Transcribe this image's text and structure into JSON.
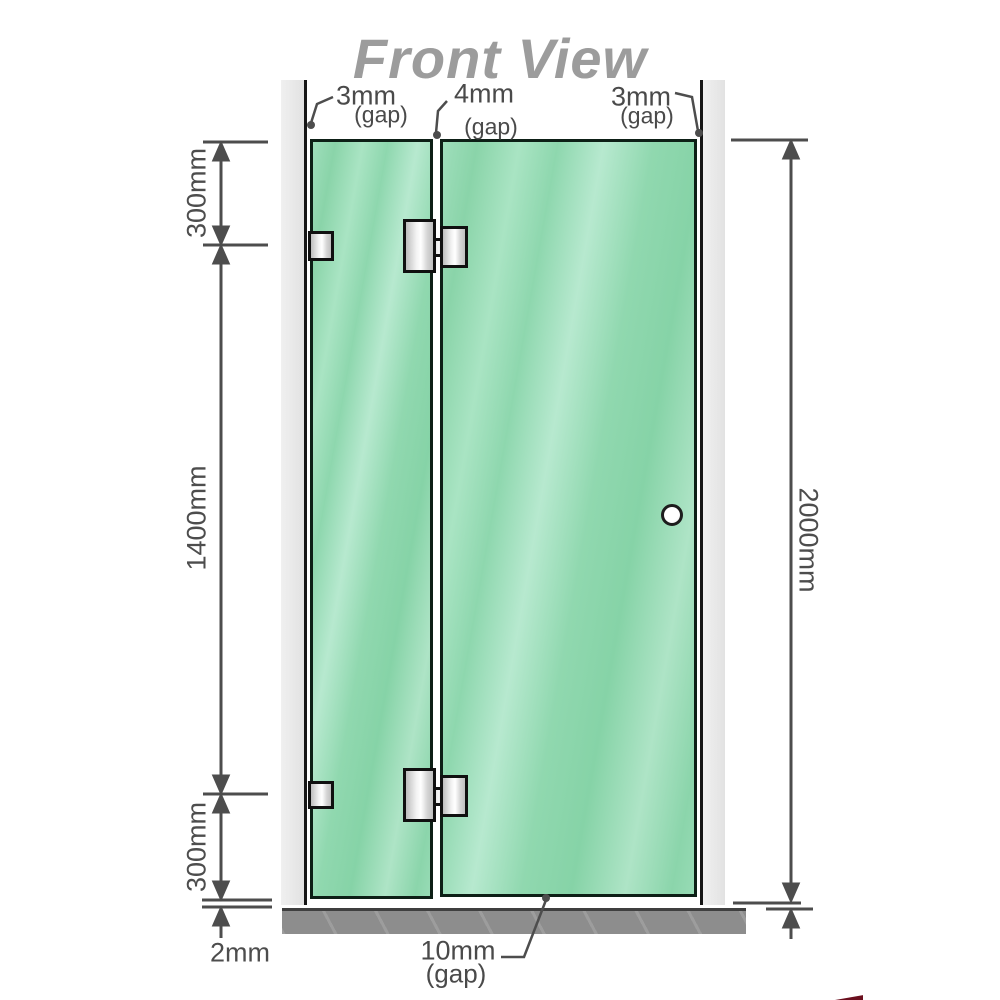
{
  "title": "Front View",
  "gaps": {
    "top_left": {
      "value": "3mm",
      "suffix": "(gap)"
    },
    "top_mid": {
      "value": "4mm",
      "suffix": "(gap)"
    },
    "top_right": {
      "value": "3mm",
      "suffix": "(gap)"
    },
    "bottom": {
      "value": "10mm",
      "suffix": "(gap)"
    }
  },
  "dimensions": {
    "left_top": "300mm",
    "left_mid": "1400mm",
    "left_bottom": "300mm",
    "floor_gap": "2mm",
    "right_total": "2000mm"
  },
  "colors": {
    "glass_green": "#8fd7ae",
    "wall_channel": "#e7e7e7",
    "floor_gray": "#8d8d8d",
    "dimension_line": "#4d4d4d",
    "title_gray": "#9c9c9c",
    "hinge_metal": "#e0e0e0",
    "watermark_red": "#6b0f1e"
  }
}
